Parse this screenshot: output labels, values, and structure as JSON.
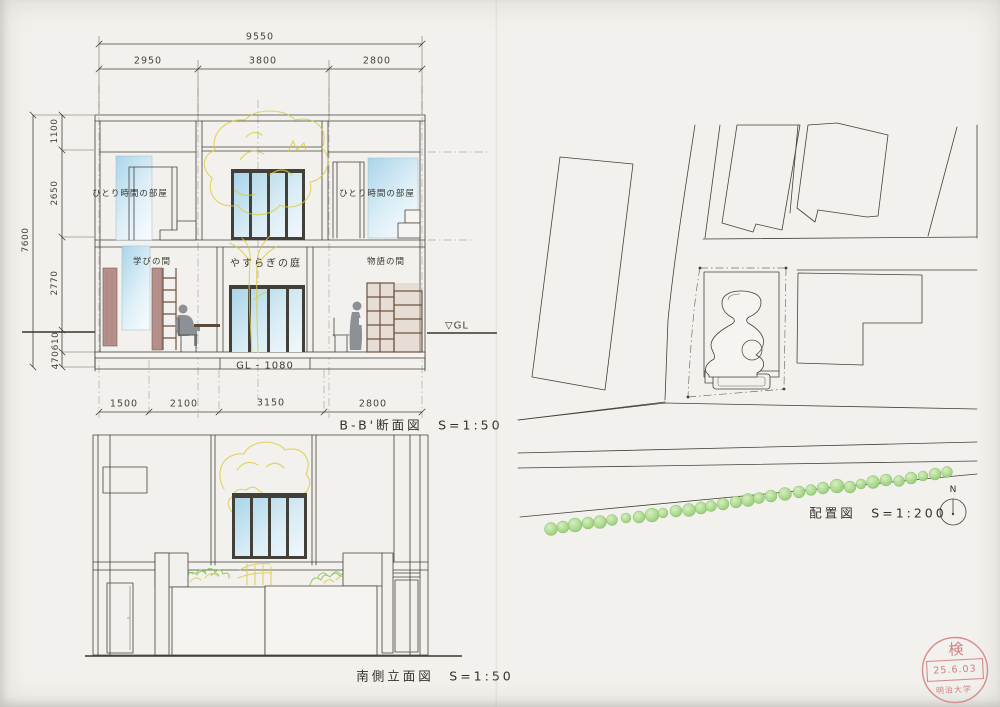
{
  "section": {
    "title": "B-B'断面図　S=1:50",
    "dims": {
      "total_width": "9550",
      "top": [
        "2950",
        "3800",
        "2800"
      ],
      "total_height": "7600",
      "left": [
        "1100",
        "2650",
        "2770",
        "610",
        "470"
      ],
      "bottom": [
        "1500",
        "2100",
        "3150",
        "2800"
      ]
    },
    "labels": {
      "room_upper_left": "ひとり時間の部屋",
      "room_upper_right": "ひとり時間の部屋",
      "room_lower_left": "学びの間",
      "courtyard": "やすらぎの庭",
      "room_lower_right": "物語の間",
      "gl": "▽GL",
      "floor_level": "GL - 1080"
    }
  },
  "elevation": {
    "title": "南側立面図　S=1:50"
  },
  "site_plan": {
    "title": "配置図　S=1:200",
    "compass": "N"
  },
  "stamp": {
    "kanji": "検",
    "date": "25.6.03",
    "university": "明治大学"
  },
  "colors": {
    "paper": "#f2f1ed",
    "ink": "#45423c",
    "glass_blue": "#a8d4e8",
    "tree_yellow": "#dcca3c",
    "foliage_green": "#82c24e",
    "wood_brown": "#6f523f",
    "panel_mauve": "#b5908a",
    "figure_gray": "#8d9196",
    "stamp_red": "#cb7272"
  }
}
